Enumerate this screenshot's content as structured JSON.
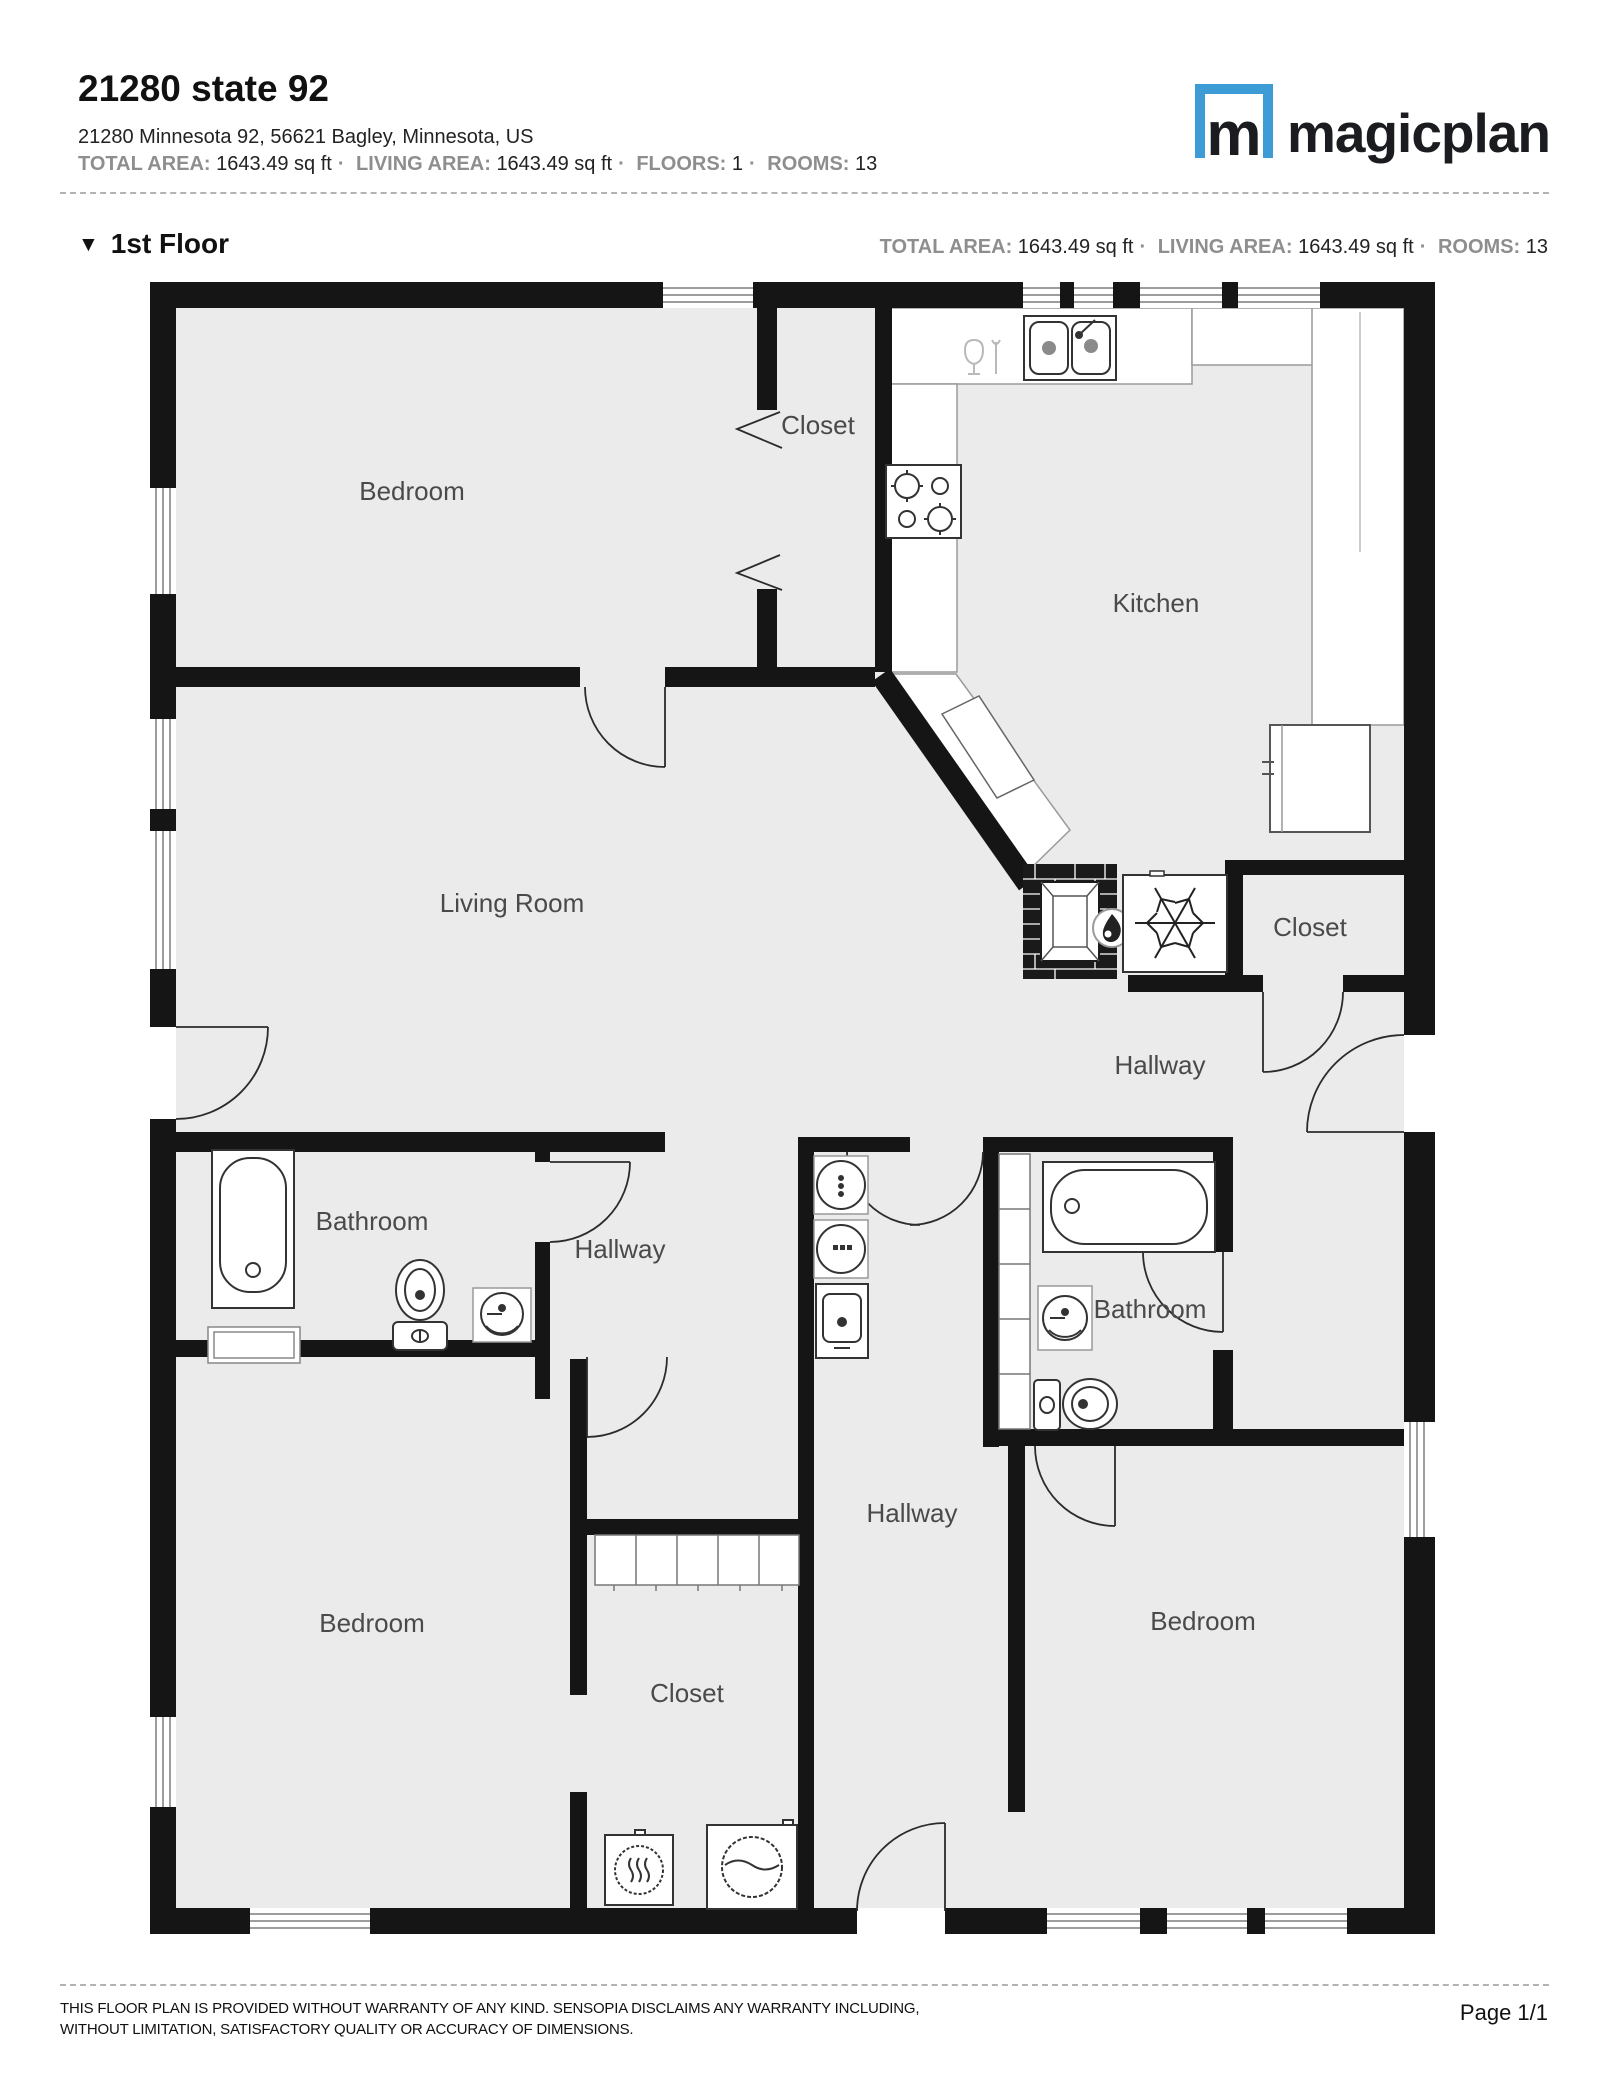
{
  "header": {
    "title": "21280 state 92",
    "address": "21280 Minnesota 92, 56621 Bagley, Minnesota, US",
    "separator": "·",
    "meta": [
      {
        "label": "TOTAL AREA:",
        "value": "1643.49 sq ft"
      },
      {
        "label": "LIVING AREA:",
        "value": "1643.49 sq ft"
      },
      {
        "label": "FLOORS:",
        "value": "1"
      },
      {
        "label": "ROOMS:",
        "value": "13"
      }
    ]
  },
  "logo": {
    "monogram": "m",
    "wordmark": "magicplan",
    "brand_color": "#3D9BD5"
  },
  "floor_section": {
    "collapse_icon": "▼",
    "name": "1st Floor",
    "meta": [
      {
        "label": "TOTAL AREA:",
        "value": "1643.49 sq ft"
      },
      {
        "label": "LIVING AREA:",
        "value": "1643.49 sq ft"
      },
      {
        "label": "ROOMS:",
        "value": "13"
      }
    ]
  },
  "floor_plan": {
    "wall_color": "#151515",
    "floor_color": "#ebebec",
    "rooms": [
      {
        "label": "Bedroom",
        "position": "top-left"
      },
      {
        "label": "Closet",
        "position": "top-middle"
      },
      {
        "label": "Kitchen",
        "position": "top-right"
      },
      {
        "label": "Living Room",
        "position": "middle-left"
      },
      {
        "label": "Closet",
        "position": "middle-right"
      },
      {
        "label": "Hallway",
        "position": "right"
      },
      {
        "label": "Bathroom",
        "position": "left"
      },
      {
        "label": "Hallway",
        "position": "center-left"
      },
      {
        "label": "Bathroom",
        "position": "center-right"
      },
      {
        "label": "Hallway",
        "position": "center-bottom"
      },
      {
        "label": "Bedroom",
        "position": "bottom-left"
      },
      {
        "label": "Closet",
        "position": "bottom-middle"
      },
      {
        "label": "Bedroom",
        "position": "bottom-right"
      }
    ],
    "fixtures": [
      "double-sink",
      "dishes",
      "stove",
      "counter",
      "refrigerator",
      "fireplace",
      "flame",
      "air-conditioner",
      "snowflake",
      "water-heater",
      "bathtub",
      "toilet",
      "washbasin",
      "washer",
      "dryer",
      "wardrobe",
      "laundry-sink",
      "door-arc",
      "window"
    ]
  },
  "footer": {
    "disclaimer_line1": "THIS FLOOR PLAN IS PROVIDED WITHOUT WARRANTY OF ANY KIND. SENSOPIA DISCLAIMS ANY WARRANTY INCLUDING,",
    "disclaimer_line2": "WITHOUT LIMITATION, SATISFACTORY QUALITY OR ACCURACY OF DIMENSIONS.",
    "page": "Page 1/1"
  }
}
